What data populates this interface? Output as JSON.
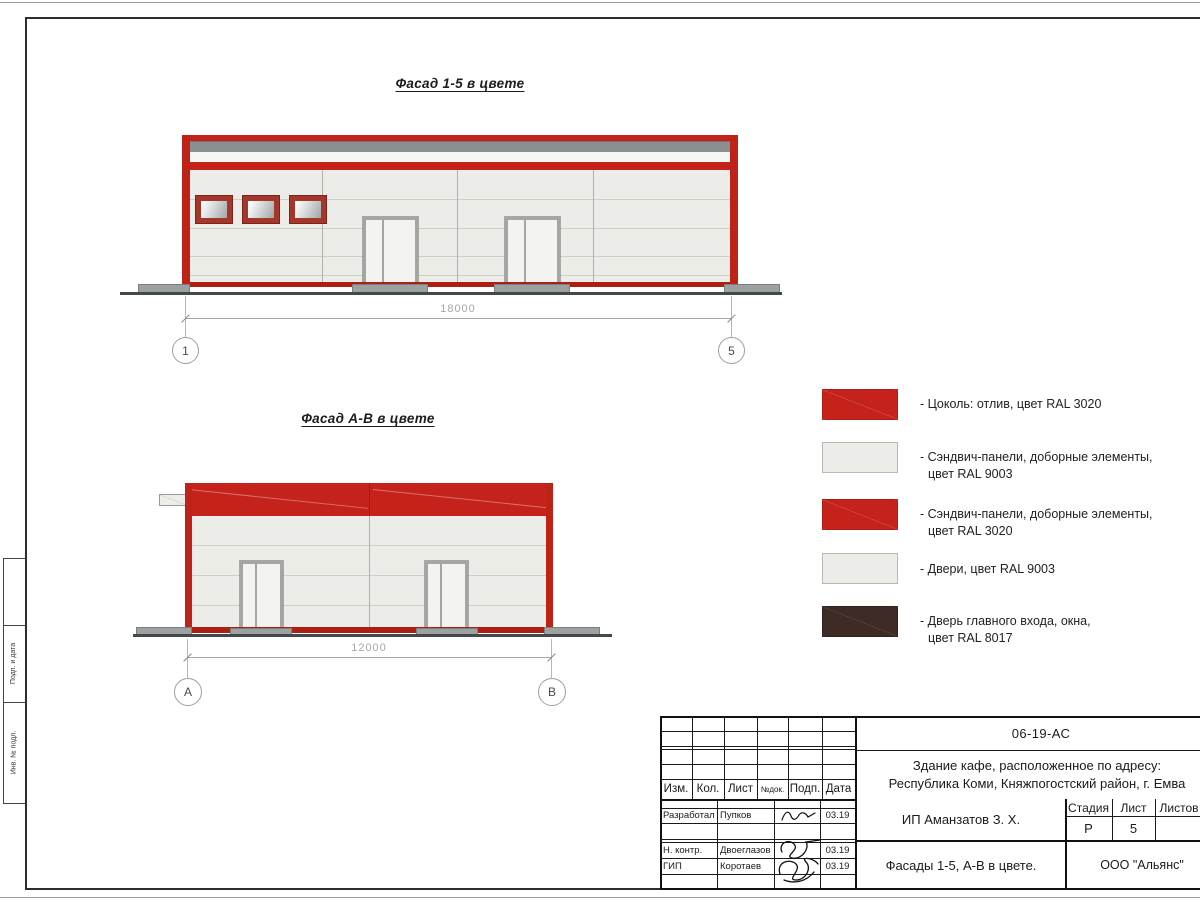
{
  "facades": {
    "f15": {
      "title": "Фасад 1-5 в цвете",
      "dim": "18000",
      "axis_left": "1",
      "axis_right": "5"
    },
    "fab": {
      "title": "Фасад А-В в цвете",
      "dim": "12000",
      "axis_left": "А",
      "axis_right": "В"
    }
  },
  "legend": {
    "items": [
      {
        "color": "#C4221A",
        "style": "red",
        "line1": "- Цоколь: отлив, цвет RAL 3020",
        "line2": ""
      },
      {
        "color": "#ECEDE8",
        "style": "light",
        "line1": "- Сэндвич-панели, доборные элементы,",
        "line2": "цвет RAL 9003"
      },
      {
        "color": "#C4221A",
        "style": "red",
        "line1": "- Сэндвич-панели, доборные элементы,",
        "line2": "цвет RAL 3020"
      },
      {
        "color": "#ECEDE8",
        "style": "light",
        "line1": "- Двери, цвет RAL 9003",
        "line2": ""
      },
      {
        "color": "#3F2B25",
        "style": "brown",
        "line1": "- Дверь главного входа, окна,",
        "line2": "цвет RAL 8017"
      }
    ]
  },
  "titleblock": {
    "doc_number": "06-19-АС",
    "object_line1": "Здание кафе, расположенное по адресу:",
    "object_line2": "Республика Коми, Княжпогостский район, г. Емва",
    "client": "ИП Аманзатов З. Х.",
    "sheet_name": "Фасады 1-5, А-В в цвете.",
    "org": "ООО \"Альянс\"",
    "stage_label": "Стадия",
    "stage_value": "Р",
    "sheet_label": "Лист",
    "sheet_value": "5",
    "sheets_label": "Листов",
    "sheets_value": "",
    "cols": {
      "izm": "Изм.",
      "kol": "Кол.",
      "list": "Лист",
      "ndoc": "№док.",
      "podp": "Подп.",
      "data": "Дата"
    },
    "rows": [
      {
        "role": "Разработал",
        "name": "Пупков",
        "date": "03.19"
      },
      {
        "role": "Н. контр.",
        "name": "Двоеглазов",
        "date": "03.19"
      },
      {
        "role": "ГИП",
        "name": "Коротаев",
        "date": "03.19"
      }
    ]
  },
  "side": {
    "labels": [
      "Подп. и дата",
      "Инв. № подл."
    ]
  },
  "colors": {
    "ral3020_red": "#C4221A",
    "ral9003_light": "#ECEDE8",
    "ral8017_brown": "#3F2B25",
    "fascia_gray": "#8C8F90"
  }
}
